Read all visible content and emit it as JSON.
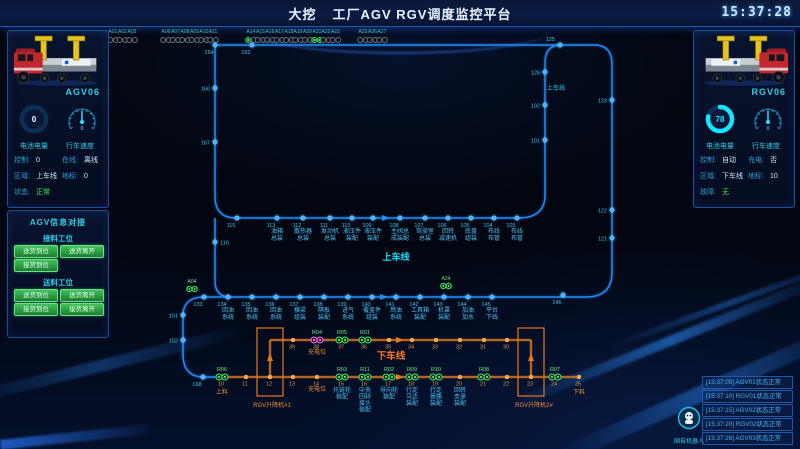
{
  "header": {
    "brand": "大挖",
    "title": "工厂AGV RGV调度监控平台",
    "clock": "15:37:28"
  },
  "left_panel": {
    "vehicle_id": "AGV06",
    "battery_value": "0",
    "speed_value": "0",
    "battery_label": "电池电量",
    "speed_label": "行车速度",
    "info": [
      {
        "k1": "控制:",
        "v1": "0",
        "k2": "在线:",
        "v2": "离线"
      },
      {
        "k1": "区域:",
        "v1": "上车线",
        "k2": "地标:",
        "v2": "0"
      },
      {
        "k1": "状态:",
        "v1": "正常"
      }
    ]
  },
  "dock_panel": {
    "title": "AGV信息对接",
    "sections": [
      {
        "label": "接料工位",
        "buttons": [
          "送货到位",
          "送货离开",
          "接货到位"
        ]
      },
      {
        "label": "送料工位",
        "buttons": [
          "送货到位",
          "送货离开",
          "接货到位",
          "接货离开"
        ]
      }
    ]
  },
  "right_panel": {
    "vehicle_id": "RGV06",
    "battery_value": "78",
    "speed_value": "0",
    "battery_label": "电池电量",
    "speed_label": "行车速度",
    "info": [
      {
        "k1": "控制:",
        "v1": "自动",
        "k2": "充电:",
        "v2": "否"
      },
      {
        "k1": "区域:",
        "v1": "下车线",
        "k2": "地标:",
        "v2": "10"
      },
      {
        "k1": "故障:",
        "v1": "无"
      }
    ]
  },
  "logs": [
    "[15:37:05] AGV01状态正常",
    "[15:37:10] RGV01状态正常",
    "[15:37:15] AGV02状态正常",
    "[15:37:20] RGV02状态正常",
    "[15:37:26] AGV03状态正常"
  ],
  "logo_text": "国自机器人",
  "colors": {
    "accent": "#00e5ff",
    "blue_line": "#1f8fff",
    "orange": "#e2791f",
    "green": "#3bf06a",
    "pink": "#ff6bf0"
  },
  "map": {
    "a_row": {
      "label_y": 33,
      "ind_y": 40,
      "stations": [
        [
          "A01",
          113,
          ""
        ],
        [
          "A02",
          122.5,
          ""
        ],
        [
          "A03",
          132,
          ""
        ],
        [
          "A06",
          166,
          ""
        ],
        [
          "A07",
          175.5,
          ""
        ],
        [
          "A08",
          185,
          ""
        ],
        [
          "A09",
          194.5,
          ""
        ],
        [
          "A10",
          204,
          ""
        ],
        [
          "A11",
          213,
          ""
        ],
        [
          "A14",
          251,
          "left"
        ],
        [
          "A15",
          260.5,
          ""
        ],
        [
          "A16",
          270,
          ""
        ],
        [
          "A17",
          279.5,
          ""
        ],
        [
          "A18",
          289,
          ""
        ],
        [
          "A19",
          298,
          ""
        ],
        [
          "A20",
          307.5,
          ""
        ],
        [
          "A21",
          317,
          "both"
        ],
        [
          "A22",
          326,
          ""
        ],
        [
          "A23",
          335.5,
          ""
        ],
        [
          "A25",
          363,
          ""
        ],
        [
          "A26",
          372.5,
          ""
        ],
        [
          "A27",
          382,
          ""
        ]
      ]
    },
    "blue_nodes": [
      [
        "164",
        215,
        45,
        "bl"
      ],
      [
        "162",
        252,
        45,
        "bl"
      ],
      [
        "125",
        560,
        45,
        "al"
      ],
      [
        "126",
        545,
        72,
        "l"
      ],
      [
        "102",
        545,
        105,
        "l"
      ],
      [
        "101",
        545,
        140,
        "l"
      ],
      [
        "123",
        612,
        100,
        "l"
      ],
      [
        "122",
        612,
        210,
        "l"
      ],
      [
        "121",
        612,
        238,
        "l"
      ],
      [
        "160",
        215,
        88,
        "l"
      ],
      [
        "167",
        215,
        142,
        "l"
      ],
      [
        "116",
        215,
        242,
        "r"
      ],
      [
        "151",
        183,
        315,
        "l"
      ],
      [
        "152",
        183,
        340,
        "l"
      ],
      [
        "168",
        203,
        377,
        "bl"
      ],
      [
        "115",
        237,
        218,
        "bl"
      ],
      [
        "113",
        277,
        218,
        "bl"
      ],
      [
        "112",
        303,
        218,
        "bl"
      ],
      [
        "111",
        330,
        218,
        "bl"
      ],
      [
        "110",
        352,
        218,
        "bl"
      ],
      [
        "109",
        373,
        218,
        "bl"
      ],
      [
        "108",
        400,
        218,
        "bl"
      ],
      [
        "107",
        425,
        218,
        "bl"
      ],
      [
        "106",
        448,
        218,
        "bl"
      ],
      [
        "105",
        471,
        218,
        "bl"
      ],
      [
        "104",
        494,
        218,
        "bl"
      ],
      [
        "103",
        517,
        218,
        "bl"
      ],
      [
        "133",
        204,
        297,
        "bl"
      ],
      [
        "134",
        228,
        297,
        "bl"
      ],
      [
        "135",
        252,
        297,
        "bl"
      ],
      [
        "136",
        276,
        297,
        "bl"
      ],
      [
        "137",
        300,
        297,
        "bl"
      ],
      [
        "138",
        324,
        297,
        "bl"
      ],
      [
        "139",
        348,
        297,
        "bl"
      ],
      [
        "140",
        372,
        297,
        "bl"
      ],
      [
        "141",
        396,
        297,
        "bl"
      ],
      [
        "142",
        420,
        297,
        "bl"
      ],
      [
        "143",
        444,
        297,
        "bl"
      ],
      [
        "144",
        468,
        297,
        "bl"
      ],
      [
        "145",
        492,
        297,
        "bl"
      ],
      [
        "146",
        563,
        295,
        "bl"
      ]
    ],
    "row1_labels_y": 233,
    "row1_labels": [
      [
        277,
        [
          "油箱",
          "总装"
        ]
      ],
      [
        303,
        [
          "散热器",
          "总装"
        ]
      ],
      [
        330,
        [
          "发动机",
          "总装"
        ]
      ],
      [
        352,
        [
          "液压件",
          "装配"
        ]
      ],
      [
        373,
        [
          "液压件",
          "装配"
        ]
      ],
      [
        400,
        [
          "主阀总",
          "成装配"
        ]
      ],
      [
        425,
        [
          "驾驶室",
          "总装"
        ]
      ],
      [
        448,
        [
          "回转",
          "减速机"
        ]
      ],
      [
        471,
        [
          "底盘",
          "组装"
        ]
      ],
      [
        494,
        [
          "布线",
          "布管"
        ]
      ],
      [
        517,
        [
          "布线",
          "布管"
        ]
      ]
    ],
    "row2_labels_y": 312,
    "row2_labels": [
      [
        228,
        [
          "回油",
          "系统"
        ]
      ],
      [
        252,
        [
          "回油",
          "系统"
        ]
      ],
      [
        276,
        [
          "回油",
          "系统"
        ]
      ],
      [
        300,
        [
          "横梁",
          "组装"
        ]
      ],
      [
        324,
        [
          "隔板",
          "装配"
        ]
      ],
      [
        348,
        [
          "进气",
          "系统"
        ]
      ],
      [
        372,
        [
          "覆盖件",
          "组装"
        ]
      ],
      [
        396,
        [
          "燃油",
          "系统"
        ]
      ],
      [
        420,
        [
          "工具箱",
          "装配"
        ]
      ],
      [
        444,
        [
          "机罩",
          "装配"
        ]
      ],
      [
        468,
        [
          "加油",
          "加水"
        ]
      ],
      [
        492,
        [
          "平台",
          "下线"
        ]
      ]
    ],
    "orange_top_y": 340,
    "orange_top": [
      [
        "39",
        293
      ],
      [
        "38",
        317
      ],
      [
        "37",
        342
      ],
      [
        "36",
        365
      ],
      [
        "35",
        389
      ],
      [
        "34",
        412
      ],
      [
        "33",
        436
      ],
      [
        "32",
        460
      ],
      [
        "31",
        484
      ],
      [
        "30",
        507
      ]
    ],
    "orange_bottom_y": 377,
    "orange_bottom": [
      [
        "10",
        222
      ],
      [
        "11",
        246
      ],
      [
        "12",
        270
      ],
      [
        "13",
        293
      ],
      [
        "14",
        317
      ],
      [
        "15",
        342
      ],
      [
        "16",
        365
      ],
      [
        "17",
        389
      ],
      [
        "18",
        412
      ],
      [
        "19",
        436
      ],
      [
        "20",
        460
      ],
      [
        "21",
        484
      ],
      [
        "22",
        507
      ],
      [
        "23",
        531
      ],
      [
        "24",
        555
      ],
      [
        "25",
        579
      ]
    ],
    "orange_labels_y": 392,
    "orange_labels": [
      [
        342,
        [
          "托链轮",
          "装配"
        ]
      ],
      [
        365,
        [
          "中央",
          "回转",
          "接头",
          "装配"
        ]
      ],
      [
        389,
        [
          "导向轮",
          "装配"
        ]
      ],
      [
        412,
        [
          "行走",
          "马达",
          "装配"
        ]
      ],
      [
        436,
        [
          "行走",
          "管路",
          "装配"
        ]
      ],
      [
        460,
        [
          "回转",
          "支承",
          "装配"
        ]
      ]
    ],
    "r_markers": [
      [
        "R04",
        317,
        340,
        "pink"
      ],
      [
        "R05",
        342,
        340,
        "green"
      ],
      [
        "R01",
        365,
        340,
        "green"
      ],
      [
        "R06",
        222,
        377,
        "green"
      ],
      [
        "R03",
        342,
        377,
        "green"
      ],
      [
        "R11",
        365,
        377,
        "green"
      ],
      [
        "R02",
        389,
        377,
        "green"
      ],
      [
        "R09",
        412,
        377,
        "green"
      ],
      [
        "R10",
        436,
        377,
        "green"
      ],
      [
        "R08",
        484,
        377,
        "green"
      ],
      [
        "R07",
        555,
        377,
        "green"
      ]
    ],
    "a_markers": [
      [
        "A04",
        192,
        289
      ],
      [
        "A24",
        446,
        286
      ]
    ],
    "lift_boxes": [
      {
        "x": 257,
        "y": 328,
        "w": 26,
        "h": 68,
        "label": "RGV升降机#1",
        "lx": 272,
        "ly": 407
      },
      {
        "x": 518,
        "y": 328,
        "w": 26,
        "h": 68,
        "label": "RGV升降机2#",
        "lx": 534,
        "ly": 407
      }
    ],
    "texts": [
      [
        "上车线",
        396,
        260,
        "big-cyan"
      ],
      [
        "上车线",
        556,
        90,
        "small-cyan"
      ],
      [
        "下车线",
        391,
        359,
        "big-orange"
      ],
      [
        "充电位",
        317,
        354,
        "small-orange"
      ],
      [
        "充电位",
        317,
        391,
        "small-orange"
      ],
      [
        "上料",
        222,
        394,
        "small-orange"
      ],
      [
        "下料",
        579,
        394,
        "small-orange"
      ]
    ],
    "arrows": [
      [
        386,
        218,
        "r",
        "blue"
      ],
      [
        384,
        297,
        "r",
        "blue"
      ],
      [
        400,
        340,
        "r",
        "orange"
      ],
      [
        400,
        377,
        "r",
        "orange"
      ],
      [
        270,
        357,
        "u",
        "orange"
      ],
      [
        531,
        357,
        "u",
        "orange"
      ]
    ]
  }
}
